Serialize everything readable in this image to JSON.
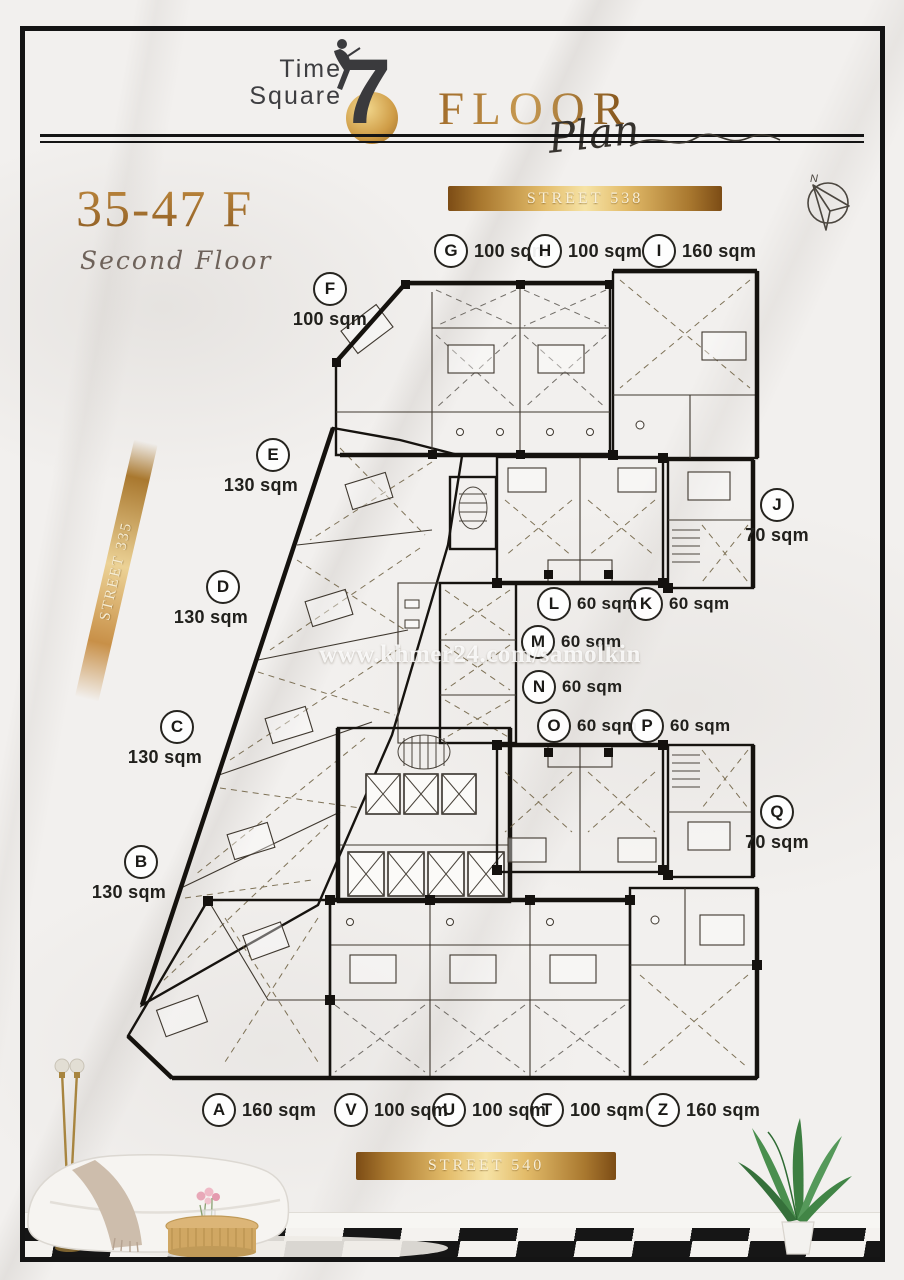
{
  "header": {
    "logo": {
      "word1": "Time",
      "word2": "Square",
      "number": "7"
    },
    "title_word": "FLOOR",
    "title_script": "Plan"
  },
  "floor_info": {
    "range": "35-47 F",
    "label": "Second Floor"
  },
  "streets": {
    "top": "STREET 538",
    "left": "STREET 335",
    "bottom": "STREET 540"
  },
  "compass_label": "N",
  "watermark": "www.khmer24.com/samolkin",
  "units": [
    {
      "id": "A",
      "area": "160 sqm"
    },
    {
      "id": "B",
      "area": "130 sqm"
    },
    {
      "id": "C",
      "area": "130 sqm"
    },
    {
      "id": "D",
      "area": "130 sqm"
    },
    {
      "id": "E",
      "area": "130 sqm"
    },
    {
      "id": "F",
      "area": "100 sqm"
    },
    {
      "id": "G",
      "area": "100 sqm"
    },
    {
      "id": "H",
      "area": "100 sqm"
    },
    {
      "id": "I",
      "area": "160 sqm"
    },
    {
      "id": "J",
      "area": "70 sqm"
    },
    {
      "id": "K",
      "area": "60 sqm"
    },
    {
      "id": "L",
      "area": "60 sqm"
    },
    {
      "id": "M",
      "area": "60 sqm"
    },
    {
      "id": "N",
      "area": "60 sqm"
    },
    {
      "id": "O",
      "area": "60 sqm"
    },
    {
      "id": "P",
      "area": "60 sqm"
    },
    {
      "id": "Q",
      "area": "70 sqm"
    },
    {
      "id": "T",
      "area": "100 sqm"
    },
    {
      "id": "U",
      "area": "100 sqm"
    },
    {
      "id": "V",
      "area": "100 sqm"
    },
    {
      "id": "Z",
      "area": "160 sqm"
    }
  ],
  "colors": {
    "title_gold": "#a06a28",
    "banner_gold": "#c89048",
    "gold_unit": "#eec25e",
    "orange_unit": "#d3894a",
    "tan_unit": "#d4b48c",
    "gray_unit": "#c9c9cd",
    "teal_unit": "#a7bfb5",
    "wall": "#1a1714"
  }
}
